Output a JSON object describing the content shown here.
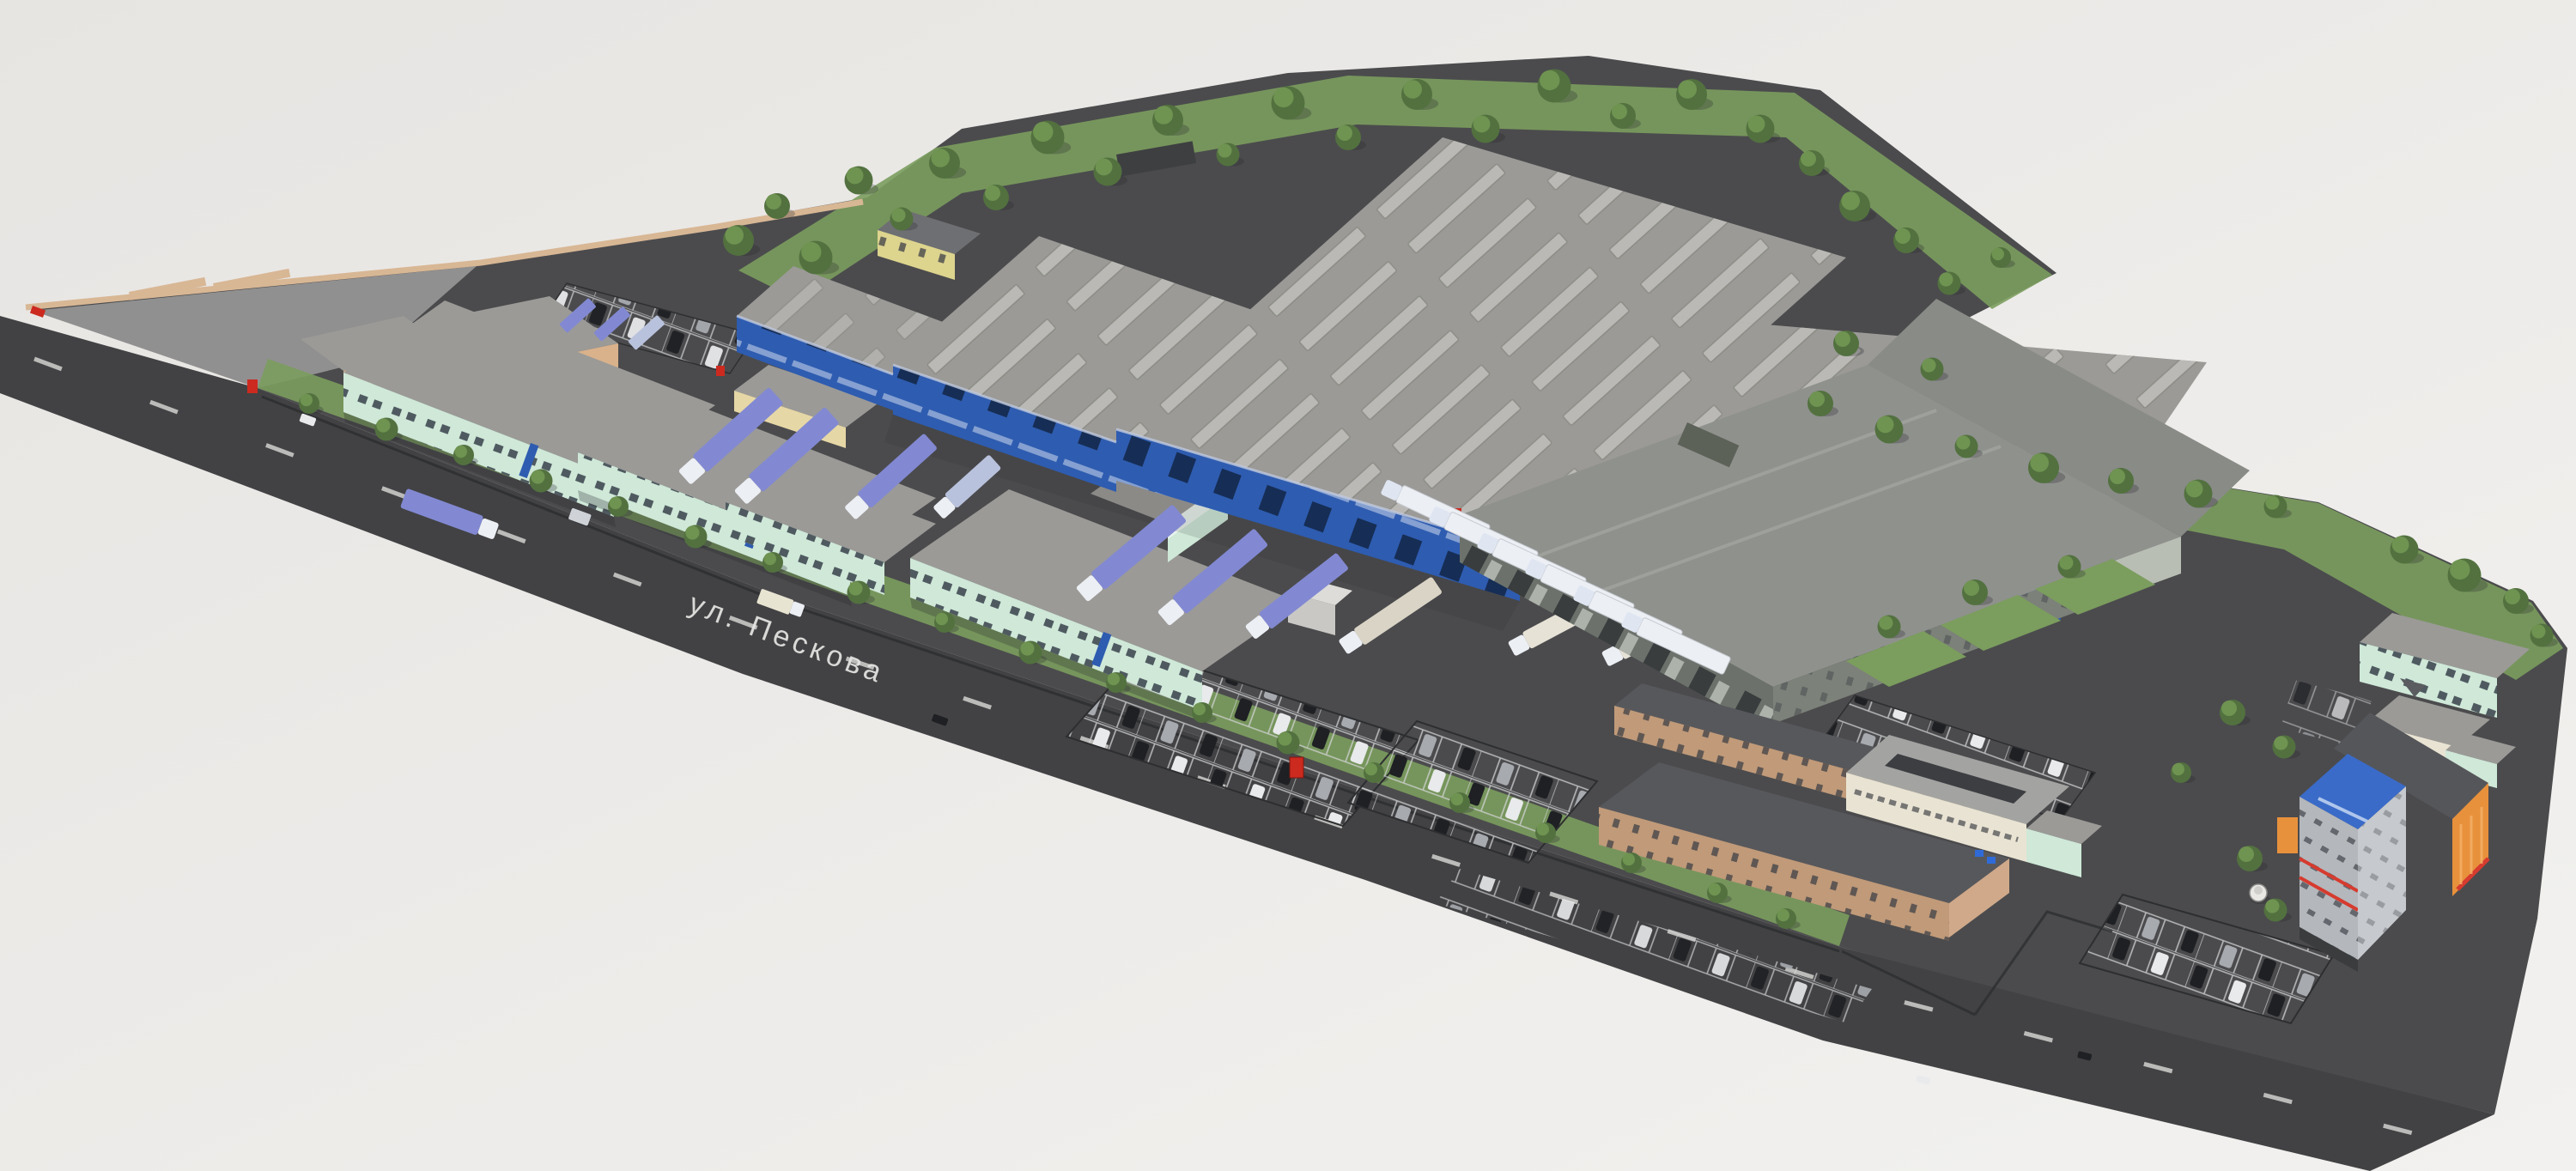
{
  "scene": {
    "type": "aerial-3d-site-render",
    "description": "Aerial 3D visualization of an industrial logistics park with warehouses, loading docks, trucks and parking lots",
    "street_label": "ул. Пескова"
  },
  "palette": {
    "bg-start": "#e7e5e2",
    "bg-end": "#f2f1ef",
    "site-asphalt": "#4b4b4d",
    "road-asphalt": "#424244",
    "road-marking": "#d9d9d7",
    "lot-concrete": "#919090",
    "perimeter-wall": "#d8b795",
    "tan-building": "#d9b28c",
    "cream-shed": "#e6d7a6",
    "mint-wall": "#cfe8d8",
    "mint-window": "#39414b",
    "roof-gray": "#9b9a97",
    "skylight": "#bab9b6",
    "blue-facade": "#2e5cb0",
    "blue-facade-dark": "#20448f",
    "grass": "#7b9d5e",
    "tree-dark": "#52713f",
    "tree-light": "#6f9351",
    "truck-blue": "#8289d2",
    "truck-white": "#eceff4",
    "warehouse-dark-wall": "#6c726b",
    "warehouse-dark-roof": "#8f918d",
    "brick": "#c09a79",
    "brick-roof": "#57585c",
    "cream-building": "#e9e3d3",
    "tower-gray": "#b4b7bb",
    "tower-blue": "#3a6bc8",
    "stripe-red": "#d63b2f",
    "orange-building": "#e8913c",
    "yellow-building": "#ddd48e",
    "car-dark": "#1e2023",
    "car-white": "#e9eaec",
    "car-silver": "#a7aaaf",
    "fence": "#2d2e30",
    "red-accent": "#cc2a1f",
    "shadow": "rgba(40,40,45,0.28)"
  }
}
